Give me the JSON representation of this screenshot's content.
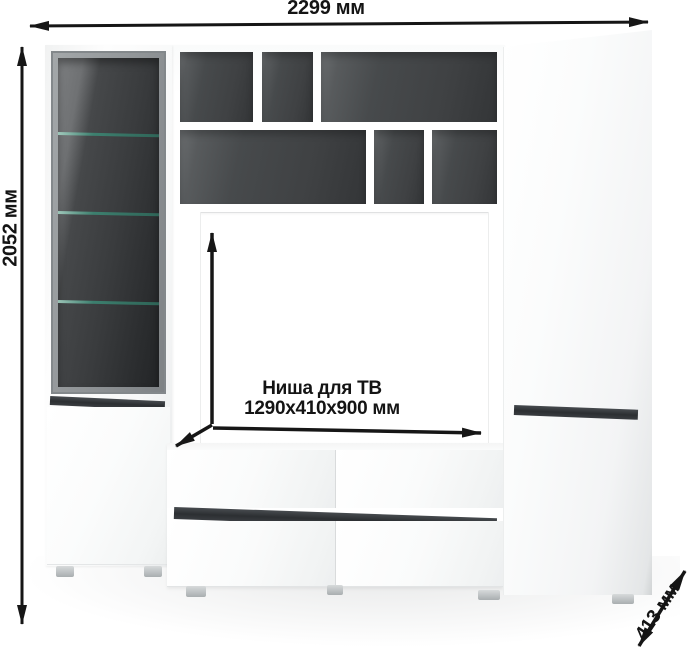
{
  "diagram": {
    "type": "furniture-dimension-drawing",
    "product": "tv-wall-unit"
  },
  "dimensions": {
    "width_label": "2299 мм",
    "height_label": "2052 мм",
    "depth_label": "413 мм",
    "niche_title": "Ниша для ТВ",
    "niche_size": "1290x410x900 мм"
  },
  "colors": {
    "background": "#ffffff",
    "dimension_ink": "#161616",
    "carcass_white": "#fdfdfd",
    "handle_strip_dark": "#2f3236",
    "shelf_interior_dark": "#45484a",
    "glass_tint_dark": "#2a2c2e",
    "glass_frame_gray": "#8d9194",
    "glass_shelf_green": "#3c8a76"
  },
  "icons": {
    "width_arrow": "double-headed-horizontal-arrow",
    "height_arrow": "double-headed-vertical-arrow",
    "depth_arrow": "double-headed-diagonal-arrow",
    "niche_arrows": "three-axis-arrows"
  }
}
